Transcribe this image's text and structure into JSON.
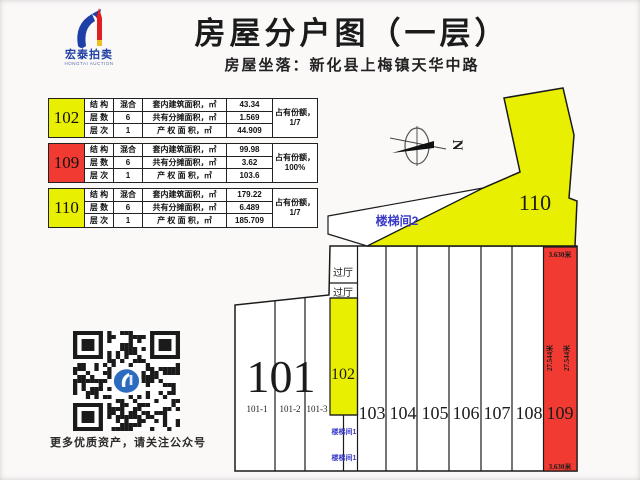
{
  "header": {
    "title": "房屋分户图（一层）",
    "subtitle": "房屋坐落：新化县上梅镇天华中路"
  },
  "logo": {
    "name": "宏泰拍卖",
    "subname": "HONGTAI AUCTION"
  },
  "tables": [
    {
      "unit": "102",
      "rows": [
        {
          "label": "结 构",
          "value": "混合",
          "metric": "套内建筑面积，㎡",
          "amount": "43.34"
        },
        {
          "label": "层 数",
          "value": "6",
          "metric": "共有分摊面积，㎡",
          "amount": "1.569"
        },
        {
          "label": "层 次",
          "value": "1",
          "metric": "产 权 面 积，㎡",
          "amount": "44.909"
        }
      ],
      "share_label": "占有份额，",
      "share_value": "1/7"
    },
    {
      "unit": "109",
      "rows": [
        {
          "label": "结 构",
          "value": "混合",
          "metric": "套内建筑面积，㎡",
          "amount": "99.98"
        },
        {
          "label": "层 数",
          "value": "6",
          "metric": "共有分摊面积，㎡",
          "amount": "3.62"
        },
        {
          "label": "层 次",
          "value": "1",
          "metric": "产 权 面 积，㎡",
          "amount": "103.6"
        }
      ],
      "share_label": "占有份额，",
      "share_value": "100%"
    },
    {
      "unit": "110",
      "rows": [
        {
          "label": "结 构",
          "value": "混合",
          "metric": "套内建筑面积，㎡",
          "amount": "179.22"
        },
        {
          "label": "层 数",
          "value": "6",
          "metric": "共有分摊面积，㎡",
          "amount": "6.489"
        },
        {
          "label": "层 次",
          "value": "1",
          "metric": "产 权 面 积，㎡",
          "amount": "185.709"
        }
      ],
      "share_label": "占有份额，",
      "share_value": "1/7"
    }
  ],
  "plan": {
    "north": "N",
    "stair2": "楼梯间2",
    "hall_a": "过厅",
    "hall_b": "过厅",
    "stair1_a": "楼梯间1",
    "stair1_b": "楼梯间1",
    "u101": "101",
    "u101_1": "101-1",
    "u101_2": "101-2",
    "u101_3": "101-3",
    "u102": "102",
    "u103": "103",
    "u104": "104",
    "u105": "105",
    "u106": "106",
    "u107": "107",
    "u108": "108",
    "u109": "109",
    "u110": "110",
    "dim_top": "3.630米",
    "dim_h1": "27.544米",
    "dim_h2": "27.544米",
    "dim_bottom": "3.630米"
  },
  "footer": {
    "qr_caption": "更多优质资产，请关注公众号"
  },
  "colors": {
    "unit_yellow": "#e9ef00",
    "unit_red": "#f13a32",
    "label_blue": "#3a3ac8"
  }
}
